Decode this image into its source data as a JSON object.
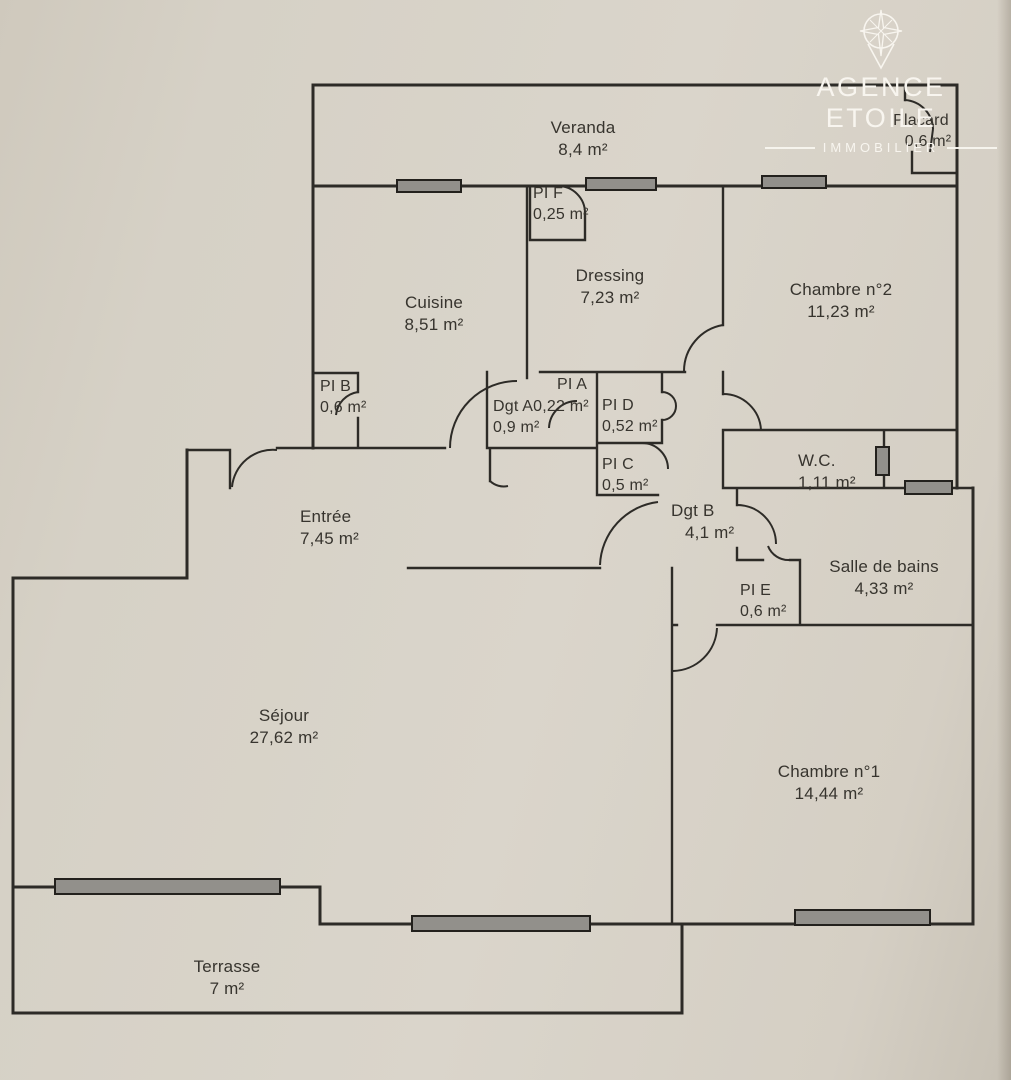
{
  "branding": {
    "agency_name": "AGENCE ETOILE",
    "tagline": "IMMOBILIER"
  },
  "rooms": {
    "veranda": {
      "name": "Veranda",
      "area": "8,4 m²"
    },
    "placard": {
      "name": "Placard",
      "area": "0,6 m²"
    },
    "pi_f": {
      "name": "PI F",
      "area": "0,25 m²"
    },
    "cuisine": {
      "name": "Cuisine",
      "area": "8,51 m²"
    },
    "dressing": {
      "name": "Dressing",
      "area": "7,23 m²"
    },
    "chambre2": {
      "name": "Chambre n°2",
      "area": "11,23 m²"
    },
    "pi_b": {
      "name": "PI B",
      "area": "0,6 m²"
    },
    "dgt_a": {
      "name": "Dgt A",
      "area": "0,9 m²"
    },
    "pi_a": {
      "name": "PI A",
      "area": "0,22 m²"
    },
    "pi_d": {
      "name": "PI D",
      "area": "0,52 m²"
    },
    "pi_c": {
      "name": "PI C",
      "area": "0,5 m²"
    },
    "dgt_b": {
      "name": "Dgt B",
      "area": "4,1 m²"
    },
    "wc": {
      "name": "W.C.",
      "area": "1,11 m²"
    },
    "entree": {
      "name": "Entrée",
      "area": "7,45 m²"
    },
    "pi_e": {
      "name": "PI E",
      "area": "0,6 m²"
    },
    "sdb": {
      "name": "Salle de bains",
      "area": "4,33 m²"
    },
    "sejour": {
      "name": "Séjour",
      "area": "27,62 m²"
    },
    "chambre1": {
      "name": "Chambre n°1",
      "area": "14,44 m²"
    },
    "terrasse": {
      "name": "Terrasse",
      "area": "7 m²"
    }
  }
}
